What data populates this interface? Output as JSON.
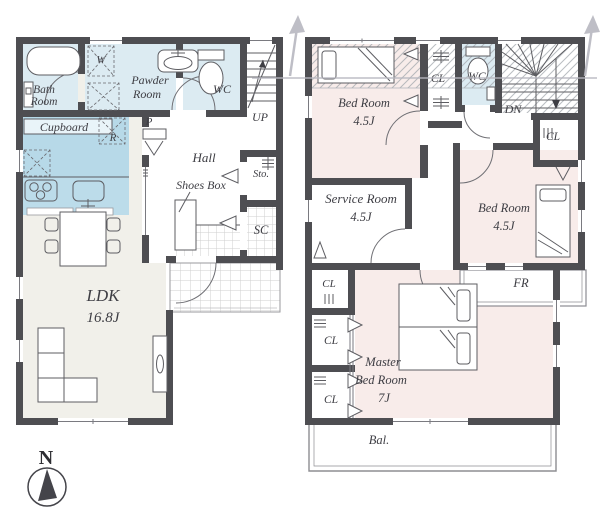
{
  "palette": {
    "wall": "#4e4e52",
    "wet_blue": "#dcebf2",
    "kitchen_blue": "#b7d9e8",
    "room_pink": "#f8ecea",
    "ldk_floor": "#f1f0ea",
    "text": "#3e3e44",
    "band_gray": "#b8b8c0"
  },
  "floor1": {
    "bath_room_line1": "Bath",
    "bath_room_line2": "Room",
    "washer_label": "W",
    "powder_room_line1": "Pawder",
    "powder_room_line2": "Room",
    "wc_label": "WC",
    "stairs_label": "UP",
    "cupboard_label": "Cupboard",
    "refrigerator_label": "R",
    "pantry_label": "P",
    "hall_label": "Hall",
    "shoes_box_label": "Shoes Box",
    "storage_label": "Sto.",
    "shoes_closet_label": "SC",
    "ldk_label": "LDK",
    "ldk_size": "16.8J"
  },
  "floor2": {
    "bedroom1_label": "Bed Room",
    "bedroom1_size": "4.5J",
    "closet_top_label": "CL",
    "wc_label": "WC",
    "stairs_label": "DN",
    "closet_right_label": "CL",
    "service_room_label": "Service Room",
    "service_room_size": "4.5J",
    "bedroom2_label": "Bed Room",
    "bedroom2_size": "4.5J",
    "free_room_label": "FR",
    "closet_a_label": "CL",
    "closet_b_label": "CL",
    "closet_c_label": "CL",
    "master_line1": "Master",
    "master_line2": "Bed Room",
    "master_line3": "7J",
    "balcony_label": "Bal."
  },
  "compass": {
    "north_label": "N"
  }
}
